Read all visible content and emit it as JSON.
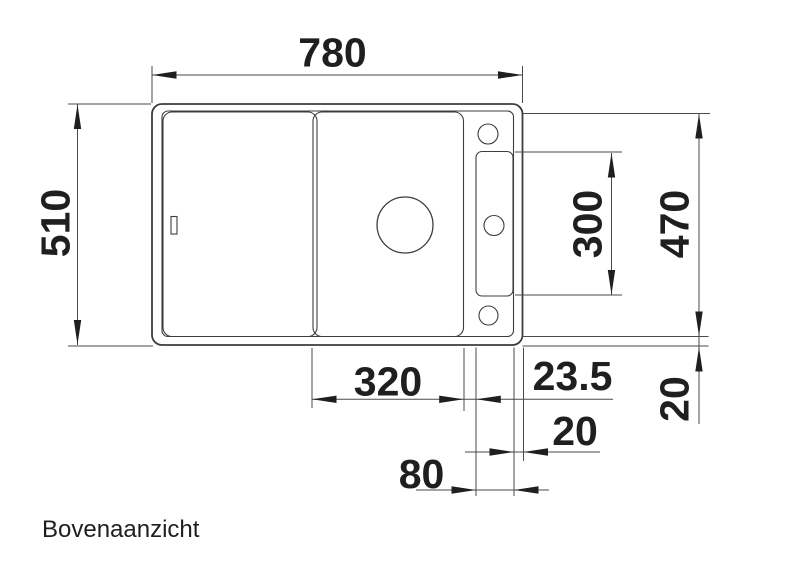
{
  "page": {
    "caption": "Bovenaanzicht",
    "background": "#ffffff"
  },
  "colors": {
    "drawing_line": "#3d3d3d",
    "dimension_line": "#4a4a4a",
    "ink": "#1f1f1f"
  },
  "dimensions": {
    "total_width": "780",
    "total_depth": "510",
    "right_edge_to_bottom_rim": "470",
    "tap_ledge_length": "300",
    "cutting_board_width": "320",
    "bowl_to_tap_ledge": "23.5",
    "tap_ledge_to_edge": "20",
    "tap_ledge_width": "80",
    "bottom_rim_depth": "20"
  }
}
